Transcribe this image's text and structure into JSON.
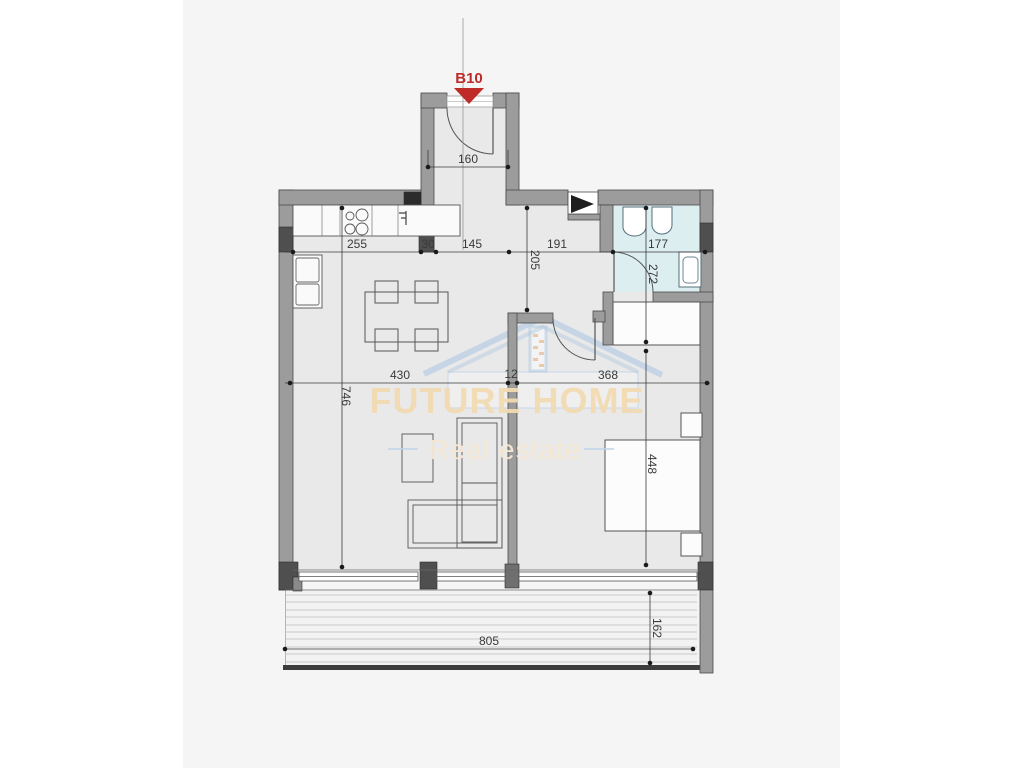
{
  "unit": {
    "label": "B10"
  },
  "watermark": {
    "title": "FUTURE HOME",
    "subtitle": "Real estate"
  },
  "dimensions": {
    "entry_width": "160",
    "kitchen_width": "255",
    "wall_seg": "30",
    "entry_hall_width": "145",
    "hall_width": "191",
    "bathroom_width": "177",
    "hall_depth": "205",
    "bathroom_depth": "272",
    "living_width": "430",
    "partition": "12",
    "bedroom_width": "368",
    "living_depth": "746",
    "bedroom_depth": "448",
    "terrace_width": "805",
    "terrace_depth": "162"
  },
  "colors": {
    "wall": "#9c9c9c",
    "wall_dark": "#4f4f4f",
    "floor": "#e9e9ea",
    "bathroom_floor": "#ddeef1",
    "terrace_floor": "#f2f2f2",
    "accent_red": "#bf2b28",
    "watermark_tan": "#f1dab1",
    "watermark_blue": "#b9cfe4",
    "dim_text": "#3a3a3a"
  }
}
